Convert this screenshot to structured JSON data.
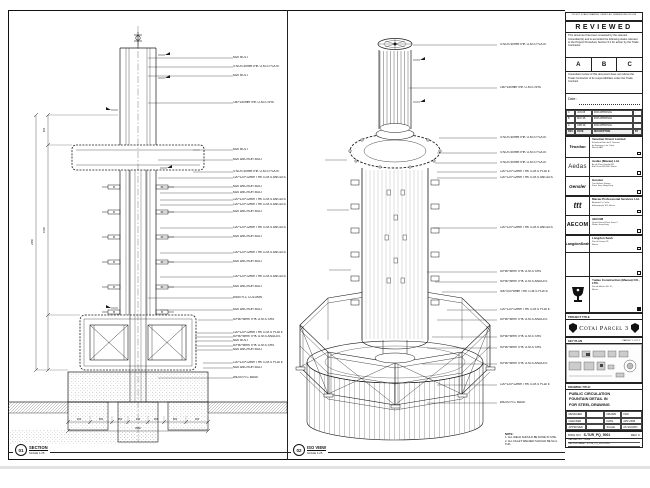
{
  "left_view": {
    "tag_number": "01",
    "tag_title": "SECTION",
    "tag_scale": "SCALE 1:25",
    "labels": [
      "M20 BOLT",
      "4 NOS 50mmTHK G.M.S PLATE",
      "M20 BOLT",
      "150*150mmTHK G.M.S SHS",
      "M20 BOLT",
      "M20 ANCHOR BOLT",
      "4 NOS 50mmTHK G.M.S PLATE",
      "120*120*12mm THK G.M.S ANGLES",
      "M20 ANCHOR BOLT",
      "M20 ANCHOR BOLT",
      "120*120*12mm THK G.M.S ANGLES",
      "120*120*12mm THK G.M.S ANGLES",
      "M20 ANCHOR BOLT",
      "120*120*12mm THK G.M.S ANGLES",
      "M20 ANCHOR BOLT",
      "120*120*12mm THK G.M.S ANGLES",
      "M20 ANCHOR BOLT",
      "120*120*12mm THK G.M.S ANGLES",
      "M20 ANCHOR BOLT",
      "Ø350 R.C COLUMN",
      "M20 ANCHOR BOLT",
      "50*50*5mm THK G.M.S SHS",
      "120*120*12mm THK G.M.S PLATE",
      "50*50*5mm THK G.M.S ANGLES",
      "M20 BOLT",
      "50*50*5mm THK G.M.S SHS",
      "M20 ANCHOR BOLT",
      "120*120*12mm THK G.M.S PLATE",
      "M20 ANCHOR BOLT",
      "Ø4200 R.C BASE"
    ],
    "dims_bottom": [
      "200",
      "660",
      "350",
      "140",
      "350",
      "660",
      "200"
    ],
    "dims_bottom_total": "2560",
    "dims_left": [
      "450",
      "1500",
      "2450"
    ]
  },
  "iso_view": {
    "tag_number": "02",
    "tag_title": "ISO VIEW",
    "tag_scale": "SCALE 1:25",
    "labels": [
      "4 NOS 50mmTHK G.M.S PLATE",
      "150*150mmTHK G.M.S SHS",
      "4 NOS 50mmTHK G.M.S PLATE",
      "4 NOS 50mmTHK G.M.S PLATE",
      "4 NOS 50mmTHK G.M.S PLATE",
      "120*120*12mm THK G.M.S PLATE",
      "120*120*12mm THK G.M.S ANGLES",
      "120*120*12mm THK G.M.S ANGLES",
      "50*50*5mm THK G.M.S SHS",
      "50*50*5mm THK G.M.S ANGLES",
      "400*200*8mm THK G.M.S PLATE",
      "120*120*12mm THK G.M.S PLATE",
      "50*50*5mm THK G.M.S ANGLES",
      "50*50*5mm THK G.M.S SHS",
      "50*50*5mm THK G.M.S SHS",
      "50*50*5mm THK G.M.S ANGLES",
      "120*120*12mm THK G.M.S PLATE",
      "Ø4200 R.C BASE"
    ],
    "note": {
      "title": "NOTE:",
      "lines": [
        "1. ALL WELD SHOULD BE DONE IN SITE.",
        "2. ALL FILLET WELDED SHOULD BE 6mm THK."
      ]
    }
  },
  "title_block": {
    "edge_note": "DO NOT SCALE DRAWING. VERIFY ALL DIMENSIONS ON SITE",
    "reviewed": {
      "title": "REVIEWED",
      "p1": "This document has been reviewed by the relevant Consultant(s) and is accorded the following status relevant to the Project Procedure Section 5.4 for action by the Trade Contractor.",
      "options": [
        "A",
        "B",
        "C"
      ],
      "p2": "Consultant review of this document does not relieve the Trade Contractor of its responsibilities under the Trade Contract.",
      "date_label": "Date :"
    },
    "revisions": {
      "rows": [
        [
          "C",
          "JUN 08",
          "FOR APPROVAL",
          "-"
        ],
        [
          "B",
          "MAY 08",
          "FOR APPROVAL",
          "-"
        ],
        [
          "A",
          "APR 08",
          "FOR APPROVAL",
          "-"
        ],
        [
          "REV.",
          "DATE",
          "DESCRIPTION",
          "BY"
        ]
      ]
    },
    "companies": [
      {
        "logo": "Venetian",
        "name": "Venetian Orient Limited",
        "address": "Estrada da Baía de N. Senhora\nda Esperança, s/n, Taipa,\nMacau SAR"
      },
      {
        "logo": "Aedas",
        "name": "Aedas (Macau) Ltd.",
        "address": "Av. da Praia Grande 665,\nEdif. Great Will 14/F, Macau"
      },
      {
        "logo": "Gensler",
        "name": "Gensler",
        "address": "Two Harbour Square,\nKwun Tong, Hong Kong"
      },
      {
        "logo": "ttt",
        "name": "Macau Professional Services Ltd.",
        "address": "Alameda Dr. Carlos\nd'Assumpção 181, Macau"
      },
      {
        "logo": "AECOM",
        "name": "AECOM",
        "address": "Grand Central Plaza Tower 2,\nShatin, Hong Kong"
      },
      {
        "logo": "LangdonSeah",
        "name": "Langdon Seah",
        "address": "Rua do Campo 78,\nMacau"
      },
      {
        "logo": "",
        "name": "",
        "address": ""
      }
    ],
    "contractor": {
      "name": "Yudao Construction (Macau) CO., LTD.",
      "address": "Rua de Malaca No. 35,\nMacau"
    },
    "project": {
      "label": "PROJECT TITLE",
      "name": "Cotai Parcel 3"
    },
    "key_plan": {
      "label": "KEY PLAN",
      "parcel": "PARCEL 1, LOT 2"
    },
    "drawing": {
      "label": "DRAWING TITLE:",
      "lines": [
        "PUBLIC CIRCULATION",
        "FOUNTAIN DETAIL IN",
        "FOR STEEL DRAWING"
      ]
    },
    "info": {
      "rows": [
        [
          "DESIGNED",
          "",
          "DRAWN",
          "LWO"
        ],
        [
          "CHECKED",
          "-",
          "DATE",
          "APR 2008"
        ],
        [
          "APPROVED",
          "-",
          "SCALE",
          "AS SHOWN"
        ]
      ]
    },
    "dwg": {
      "label": "DWG NO",
      "number": "S-TUR_PQ_5001",
      "rev": "REV C"
    },
    "cad": [
      "CAD REF. NO. : S-608",
      "CAD FILE NAME : S-TUR_PQ_5001.DWG",
      "REFERENCE CAD FILE NAME :"
    ]
  },
  "colors": {
    "line": "#1a1a1a"
  }
}
